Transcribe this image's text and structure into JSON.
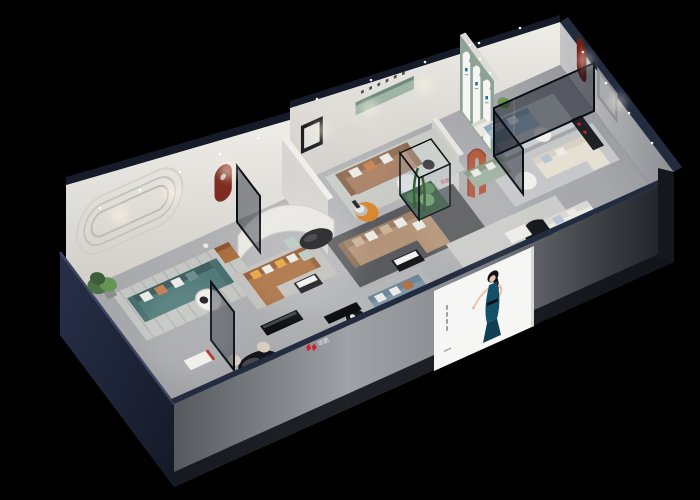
{
  "scene": {
    "description": "Isometric 3D cutaway render of a furniture showroom on a black background",
    "background": "#000000"
  },
  "brand": {
    "name": "华凯",
    "cap_sign_text": "华凯",
    "interior_sign_text": "华凯",
    "logo_red": "#d21f2c"
  },
  "poster": {
    "panel": "#f6f6f5",
    "dress": "#15506b",
    "dress_dark": "#0f3e55",
    "hair": "#0e1216",
    "skin": "#eac0a6"
  },
  "colors": {
    "floor": "#b4b5b8",
    "floor_light": "#c8c9cb",
    "floor_dark": "#8e8f93",
    "wall_navy": "#232b3f",
    "wall_navy_dark": "#161b29",
    "wall_navy_light": "#3a4560",
    "wall_white": "#e9e7e2",
    "wall_warm": "#dedbd4",
    "wall_gray": "#c9c8c6",
    "front_face_light": "#9fa2a6",
    "front_face_dark": "#23262c",
    "green_wall": "#8ea396",
    "arch_white": "#f5f5f3",
    "arch_mark_blue": "#2471a8",
    "niche_green": "#9eb4a4",
    "niche_black": "#17181b",
    "niche_red": "#7e2c20",
    "niche_darkred": "#6e1f1a",
    "arch_rust": "#b0593c",
    "sofa_teal": "#527a7a",
    "sofa_teal_dark": "#3f5f60",
    "sofa_caramel": "#a96f40",
    "sofa_caramel_dark": "#8f5a33",
    "sofa_tan": "#a87f63",
    "sofa_tan_dark": "#8f6b52",
    "sofa_beige": "#b39478",
    "sofa_beige_dark": "#9c7f66",
    "sofa_bluegray": "#7f98a8",
    "sofa_bluegray_dark": "#6d8698",
    "sofa_lightblue": "#a3bccc",
    "sofa_cream": "#e6e0d3",
    "sofa_sage": "#9fb09f",
    "sofa_white": "#ebe9e4",
    "pillow_white": "#eceae5",
    "pillow_mustard": "#e6a23c",
    "pillow_terracotta": "#c77f52",
    "pillow_lightblue": "#b7c6d4",
    "table_black": "#17181a",
    "table_white": "#f0efec",
    "table_oval": "#1b1c1f",
    "rug_blue": "#8aa2bd",
    "rug_dark": "#5a5b5e",
    "rug_light": "#c4c6c3",
    "chair_cream": "#d6cec0",
    "plant_green": "#4c7045",
    "plant_light": "#679455",
    "terrarium_green": "#3c6b35",
    "glass_tint": "#0d141f",
    "accent_orange": "#d9882f",
    "spotlight": "#fff6e6"
  }
}
